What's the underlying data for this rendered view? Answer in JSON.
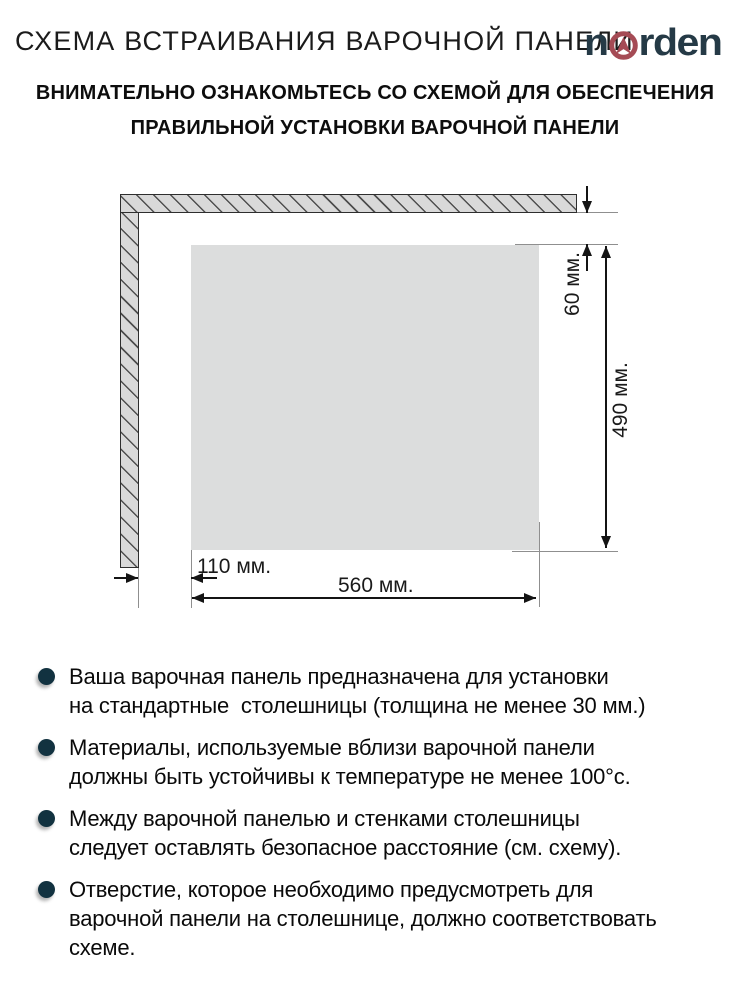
{
  "header": {
    "title": "СХЕМА ВСТРАИВАНИЯ ВАРОЧНОЙ ПАНЕЛИ",
    "logo": {
      "name": "norden",
      "part1": "n",
      "part2": "rden",
      "letter_color": "#253a46",
      "emblem_color": "#a54b55"
    },
    "subtitle_line1": "ВНИМАТЕЛЬНО ОЗНАКОМЬТЕСЬ СО СХЕМОЙ ДЛЯ ОБЕСПЕЧЕНИЯ",
    "subtitle_line2": "ПРАВИЛЬНОЙ УСТАНОВКИ ВАРОЧНОЙ ПАНЕЛИ"
  },
  "diagram": {
    "dimensions": {
      "top_gap": "60 мм.",
      "cutout_height": "490 мм.",
      "left_gap": "110 мм.",
      "cutout_width": "560 мм."
    },
    "colors": {
      "wall_fill": "#d9d9d9",
      "cutout_fill": "#dcdddd",
      "dimension_line": "#141414",
      "extension_line": "#8f8f8f"
    }
  },
  "notes": {
    "bullet_color": "#123240",
    "items": [
      {
        "lines": [
          "Ваша варочная панель предназначена для установки",
          "на стандартные  столешницы (толщина не менее 30 мм.)"
        ]
      },
      {
        "lines": [
          "Материалы, используемые вблизи варочной панели",
          "должны быть устойчивы к температуре не менее 100°с."
        ]
      },
      {
        "lines": [
          "Между варочной панелью и стенками столешницы",
          "следует оставлять безопасное расстояние (см. схему)."
        ]
      },
      {
        "lines": [
          "Отверстие, которое необходимо предусмотреть для",
          "варочной панели на столешнице, должно соответствовать",
          "схеме."
        ]
      }
    ]
  }
}
